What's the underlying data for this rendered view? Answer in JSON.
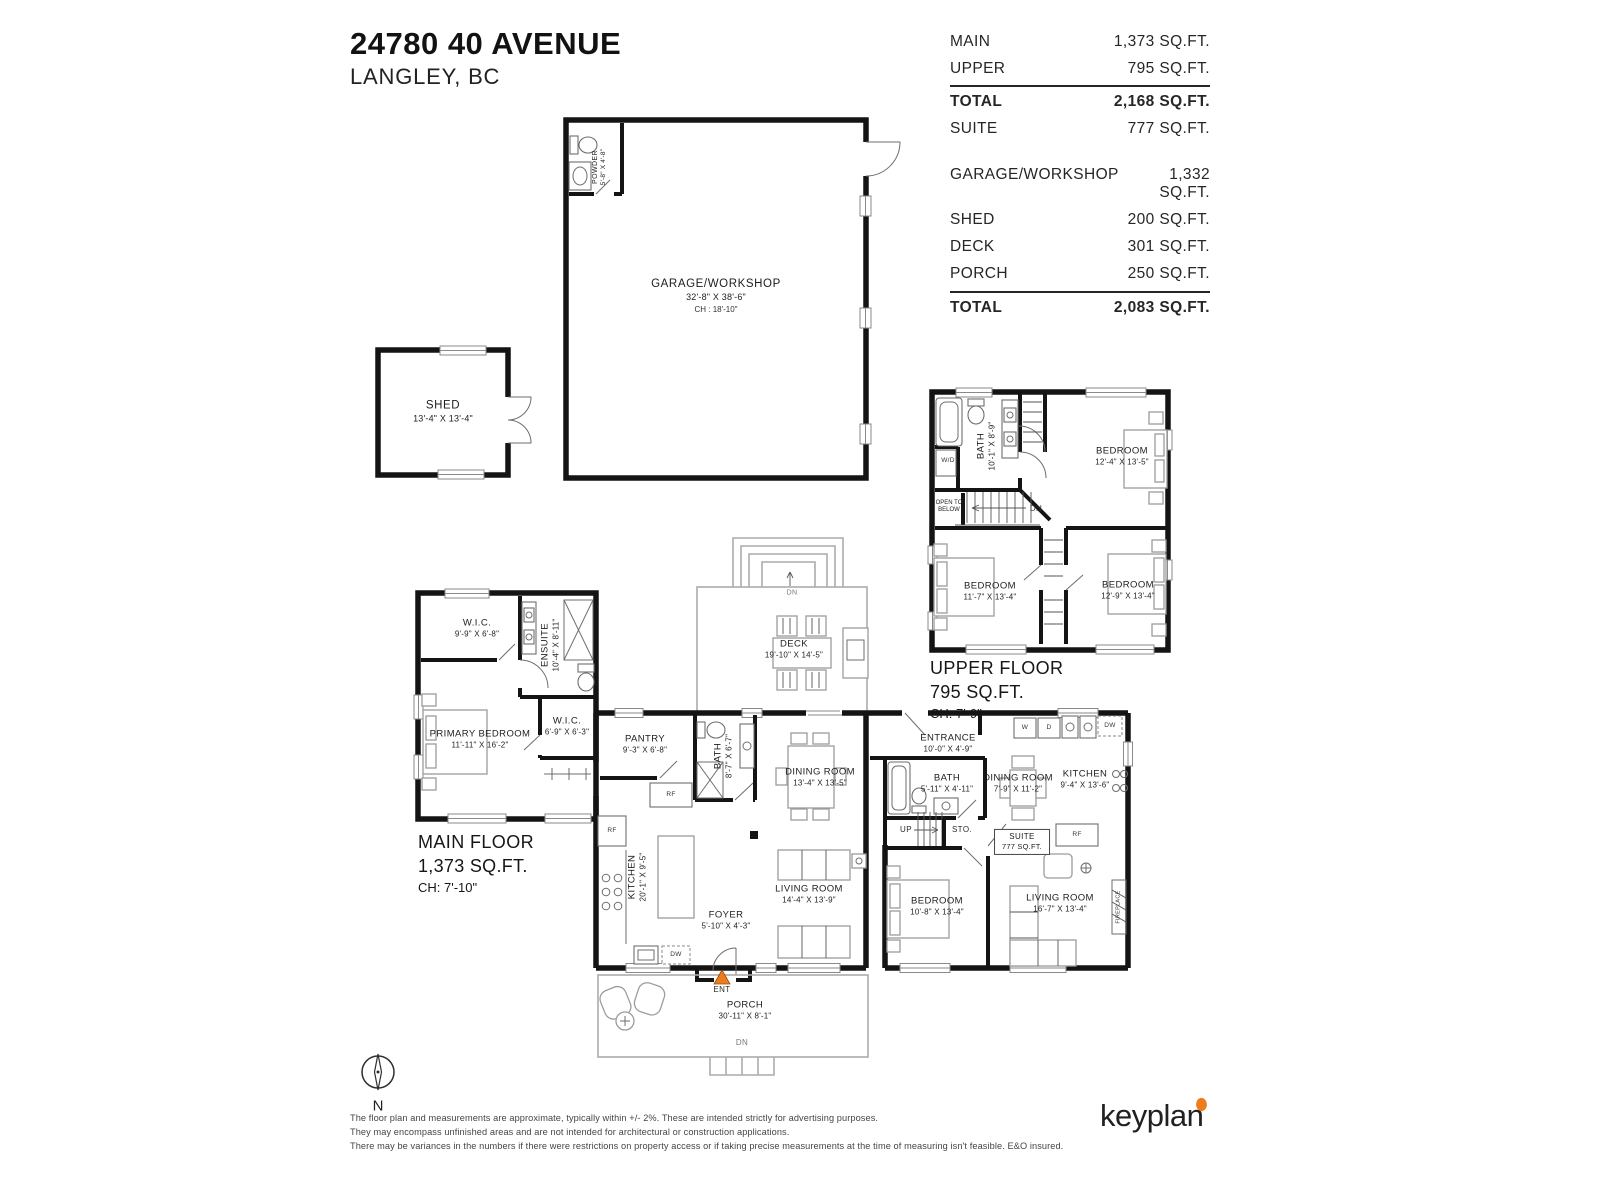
{
  "title": {
    "address": "24780 40 AVENUE",
    "city": "LANGLEY, BC"
  },
  "area_table": {
    "rows_top": [
      {
        "label": "MAIN",
        "value": "1,373 SQ.FT."
      },
      {
        "label": "UPPER",
        "value": "795 SQ.FT."
      }
    ],
    "total_main": {
      "label": "TOTAL",
      "value": "2,168 SQ.FT."
    },
    "suite_row": {
      "label": "SUITE",
      "value": "777 SQ.FT."
    },
    "rows_out": [
      {
        "label": "GARAGE/WORKSHOP",
        "value": "1,332 SQ.FT."
      },
      {
        "label": "SHED",
        "value": "200 SQ.FT."
      },
      {
        "label": "DECK",
        "value": "301 SQ.FT."
      },
      {
        "label": "PORCH",
        "value": "250 SQ.FT."
      }
    ],
    "total_out": {
      "label": "TOTAL",
      "value": "2,083 SQ.FT."
    }
  },
  "garage": {
    "name": "GARAGE/WORKSHOP",
    "dims": "32'-8\" X 38'-6\"",
    "ch": "CH : 18'-10\""
  },
  "powder": {
    "name": "POWDER",
    "dims": "5'-8\" X 4'-8\""
  },
  "shed": {
    "name": "SHED",
    "dims": "13'-4\" X 13'-4\""
  },
  "upper": {
    "title": "UPPER FLOOR",
    "area": "795 SQ.FT.",
    "ch": "CH: 7'-9\"",
    "bath": {
      "name": "BATH",
      "dims": "10'-1\" X 8'-9\""
    },
    "wd": "W/D",
    "open_below": "OPEN TO BELOW",
    "dn": "DN",
    "bed1": {
      "name": "BEDROOM",
      "dims": "12'-4\" X 13'-5\""
    },
    "bed2": {
      "name": "BEDROOM",
      "dims": "11'-7\" X 13'-4\""
    },
    "bed3": {
      "name": "BEDROOM",
      "dims": "12'-9\" X 13'-4\""
    }
  },
  "main": {
    "title": "MAIN FLOOR",
    "area": "1,373 SQ.FT.",
    "ch": "CH: 7'-10\"",
    "wic1": {
      "name": "W.I.C.",
      "dims": "9'-9\" X 6'-8\""
    },
    "ensuite": {
      "name": "ENSUITE",
      "dims": "10'-4\" X 8'-11\""
    },
    "primary": {
      "name": "PRIMARY BEDROOM",
      "dims": "11'-11\" X 16'-2\""
    },
    "wic2": {
      "name": "W.I.C.",
      "dims": "6'-9\" X 6'-3\""
    },
    "pantry": {
      "name": "PANTRY",
      "dims": "9'-3\" X 6'-8\""
    },
    "bath": {
      "name": "BATH",
      "dims": "8'-7\" X 6'-7\""
    },
    "dining": {
      "name": "DINING ROOM",
      "dims": "13'-4\" X 13'-5\""
    },
    "kitchen": {
      "name": "KITCHEN",
      "dims": "20'-1\" X 9'-5\""
    },
    "foyer": {
      "name": "FOYER",
      "dims": "5'-10\" X 4'-3\""
    },
    "living": {
      "name": "LIVING ROOM",
      "dims": "14'-4\" X 13'-9\""
    },
    "rf": "RF",
    "dw": "DW",
    "ent": "ENT"
  },
  "suite": {
    "entrance": {
      "name": "ENTRANCE",
      "dims": "10'-0\" X 4'-9\""
    },
    "bath": {
      "name": "BATH",
      "dims": "5'-11\" X 4'-11\""
    },
    "dining": {
      "name": "DINING ROOM",
      "dims": "7'-9\" X 11'-2\""
    },
    "kitchen": {
      "name": "KITCHEN",
      "dims": "9'-4\" X 13'-6\""
    },
    "bedroom": {
      "name": "BEDROOM",
      "dims": "10'-8\" X 13'-4\""
    },
    "living": {
      "name": "LIVING ROOM",
      "dims": "16'-7\" X 13'-4\""
    },
    "up": "UP",
    "sto": "STO.",
    "badge_name": "SUITE",
    "badge_area": "777 SQ.FT.",
    "w": "W",
    "d": "D",
    "dw": "DW",
    "rf": "RF",
    "fireplace": "FIREPLACE"
  },
  "deck": {
    "name": "DECK",
    "dims": "19'-10\" X 14'-5\"",
    "dn": "DN"
  },
  "porch": {
    "name": "PORCH",
    "dims": "30'-11\" X 8'-1\"",
    "dn": "DN"
  },
  "compass": {
    "north": "N"
  },
  "footer": {
    "disclaimer": [
      "The floor plan and measurements are approximate, typically within +/- 2%. These are intended strictly for advertising purposes.",
      "They may encompass unfinished areas and are not intended for architectural or construction applications.",
      "There may be variances in the numbers if there were restrictions on property access or if taking precise measurements at the time of measuring isn't feasible. E&O insured."
    ],
    "logo": "keyplan"
  },
  "colors": {
    "wall": "#141414",
    "accent_orange": "#ee7c1c"
  }
}
